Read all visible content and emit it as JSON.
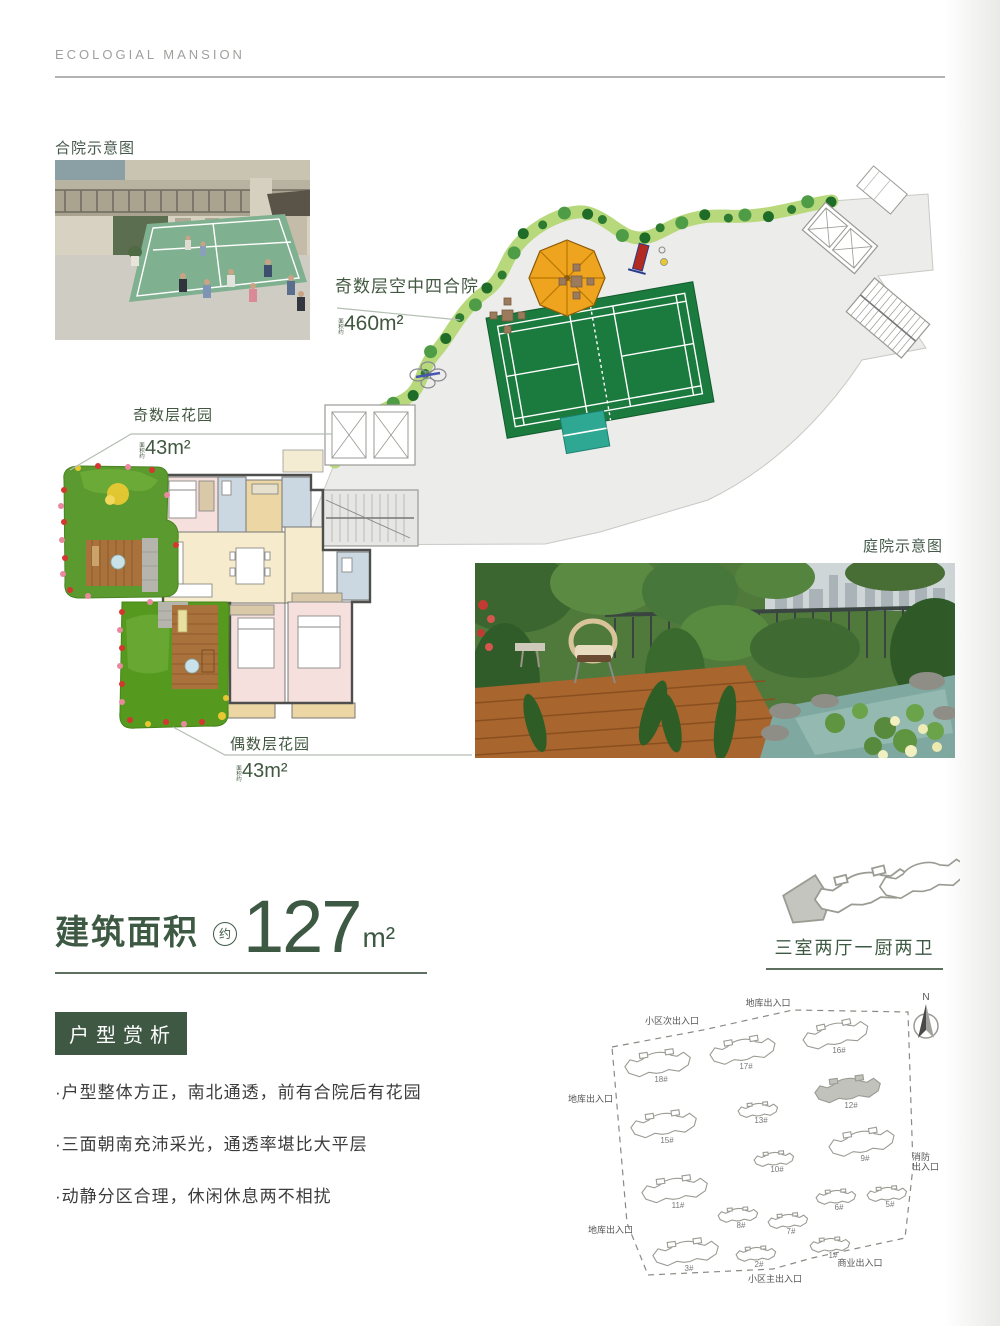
{
  "header": {
    "brand": "ECOLOGIAL MANSION"
  },
  "photos": {
    "courtyard_label": "合院示意图",
    "garden_label": "庭院示意图"
  },
  "callouts": {
    "sky_courtyard": {
      "label": "奇数层空中四合院",
      "area_prefix": "面积约",
      "area": "460m²"
    },
    "odd_garden": {
      "label": "奇数层花园",
      "area_prefix": "面积约",
      "area": "43m²"
    },
    "even_garden": {
      "label": "偶数层花园",
      "area_prefix": "面积约",
      "area": "43m²"
    }
  },
  "area_section": {
    "label": "建筑面积",
    "approx": "约",
    "value": "127",
    "unit": "m²",
    "layout": "三室两厅一厨两卫"
  },
  "analysis": {
    "title": "户型赏析",
    "bullets": [
      "·户型整体方正，南北通透，前有合院后有花园",
      "·三面朝南充沛采光，通透率堪比大平层",
      "·动静分区合理，休闲休息两不相扰"
    ]
  },
  "site_map": {
    "north": "N",
    "entrances": [
      {
        "label": "地库出入口",
        "x": 208,
        "y": 16,
        "anchor": "middle"
      },
      {
        "label": "小区次出入口",
        "x": 112,
        "y": 34,
        "anchor": "middle"
      },
      {
        "label": "地库出入口",
        "x": 8,
        "y": 112,
        "anchor": "start"
      },
      {
        "label": "地库出入口",
        "x": 28,
        "y": 243,
        "anchor": "start"
      },
      {
        "label": "消防\n出入口",
        "x": 352,
        "y": 170,
        "anchor": "start"
      },
      {
        "label": "商业出入口",
        "x": 300,
        "y": 276,
        "anchor": "middle"
      },
      {
        "label": "小区主出入口",
        "x": 215,
        "y": 292,
        "anchor": "middle"
      }
    ],
    "buildings": [
      {
        "no": "18#",
        "x": 98,
        "y": 75,
        "s": 1,
        "r": -8,
        "hl": false
      },
      {
        "no": "17#",
        "x": 183,
        "y": 62,
        "s": 1,
        "r": -10,
        "hl": false
      },
      {
        "no": "16#",
        "x": 276,
        "y": 46,
        "s": 1,
        "r": -12,
        "hl": false
      },
      {
        "no": "12#",
        "x": 288,
        "y": 101,
        "s": 1,
        "r": -8,
        "hl": true
      },
      {
        "no": "15#",
        "x": 104,
        "y": 136,
        "s": 1,
        "r": -8,
        "hl": false
      },
      {
        "no": "13#",
        "x": 198,
        "y": 121,
        "s": 0.6,
        "r": -5,
        "hl": false
      },
      {
        "no": "9#",
        "x": 302,
        "y": 154,
        "s": 1,
        "r": -10,
        "hl": false
      },
      {
        "no": "10#",
        "x": 214,
        "y": 170,
        "s": 0.6,
        "r": -5,
        "hl": false
      },
      {
        "no": "11#",
        "x": 115,
        "y": 201,
        "s": 1,
        "r": -8,
        "hl": false
      },
      {
        "no": "6#",
        "x": 276,
        "y": 208,
        "s": 0.6,
        "r": -4,
        "hl": false
      },
      {
        "no": "5#",
        "x": 327,
        "y": 205,
        "s": 0.6,
        "r": -5,
        "hl": false
      },
      {
        "no": "8#",
        "x": 178,
        "y": 226,
        "s": 0.6,
        "r": -4,
        "hl": false
      },
      {
        "no": "7#",
        "x": 228,
        "y": 232,
        "s": 0.6,
        "r": -5,
        "hl": false
      },
      {
        "no": "1#",
        "x": 270,
        "y": 256,
        "s": 0.6,
        "r": -4,
        "hl": false
      },
      {
        "no": "3#",
        "x": 126,
        "y": 264,
        "s": 1,
        "r": -8,
        "hl": false
      },
      {
        "no": "2#",
        "x": 196,
        "y": 265,
        "s": 0.6,
        "r": -4,
        "hl": false
      }
    ]
  },
  "colors": {
    "accent_green": "#3e5844",
    "court_green": "#1b7a3d",
    "hedge_green": "#b7d97c",
    "highlight_gray": "#c2c2bd"
  }
}
